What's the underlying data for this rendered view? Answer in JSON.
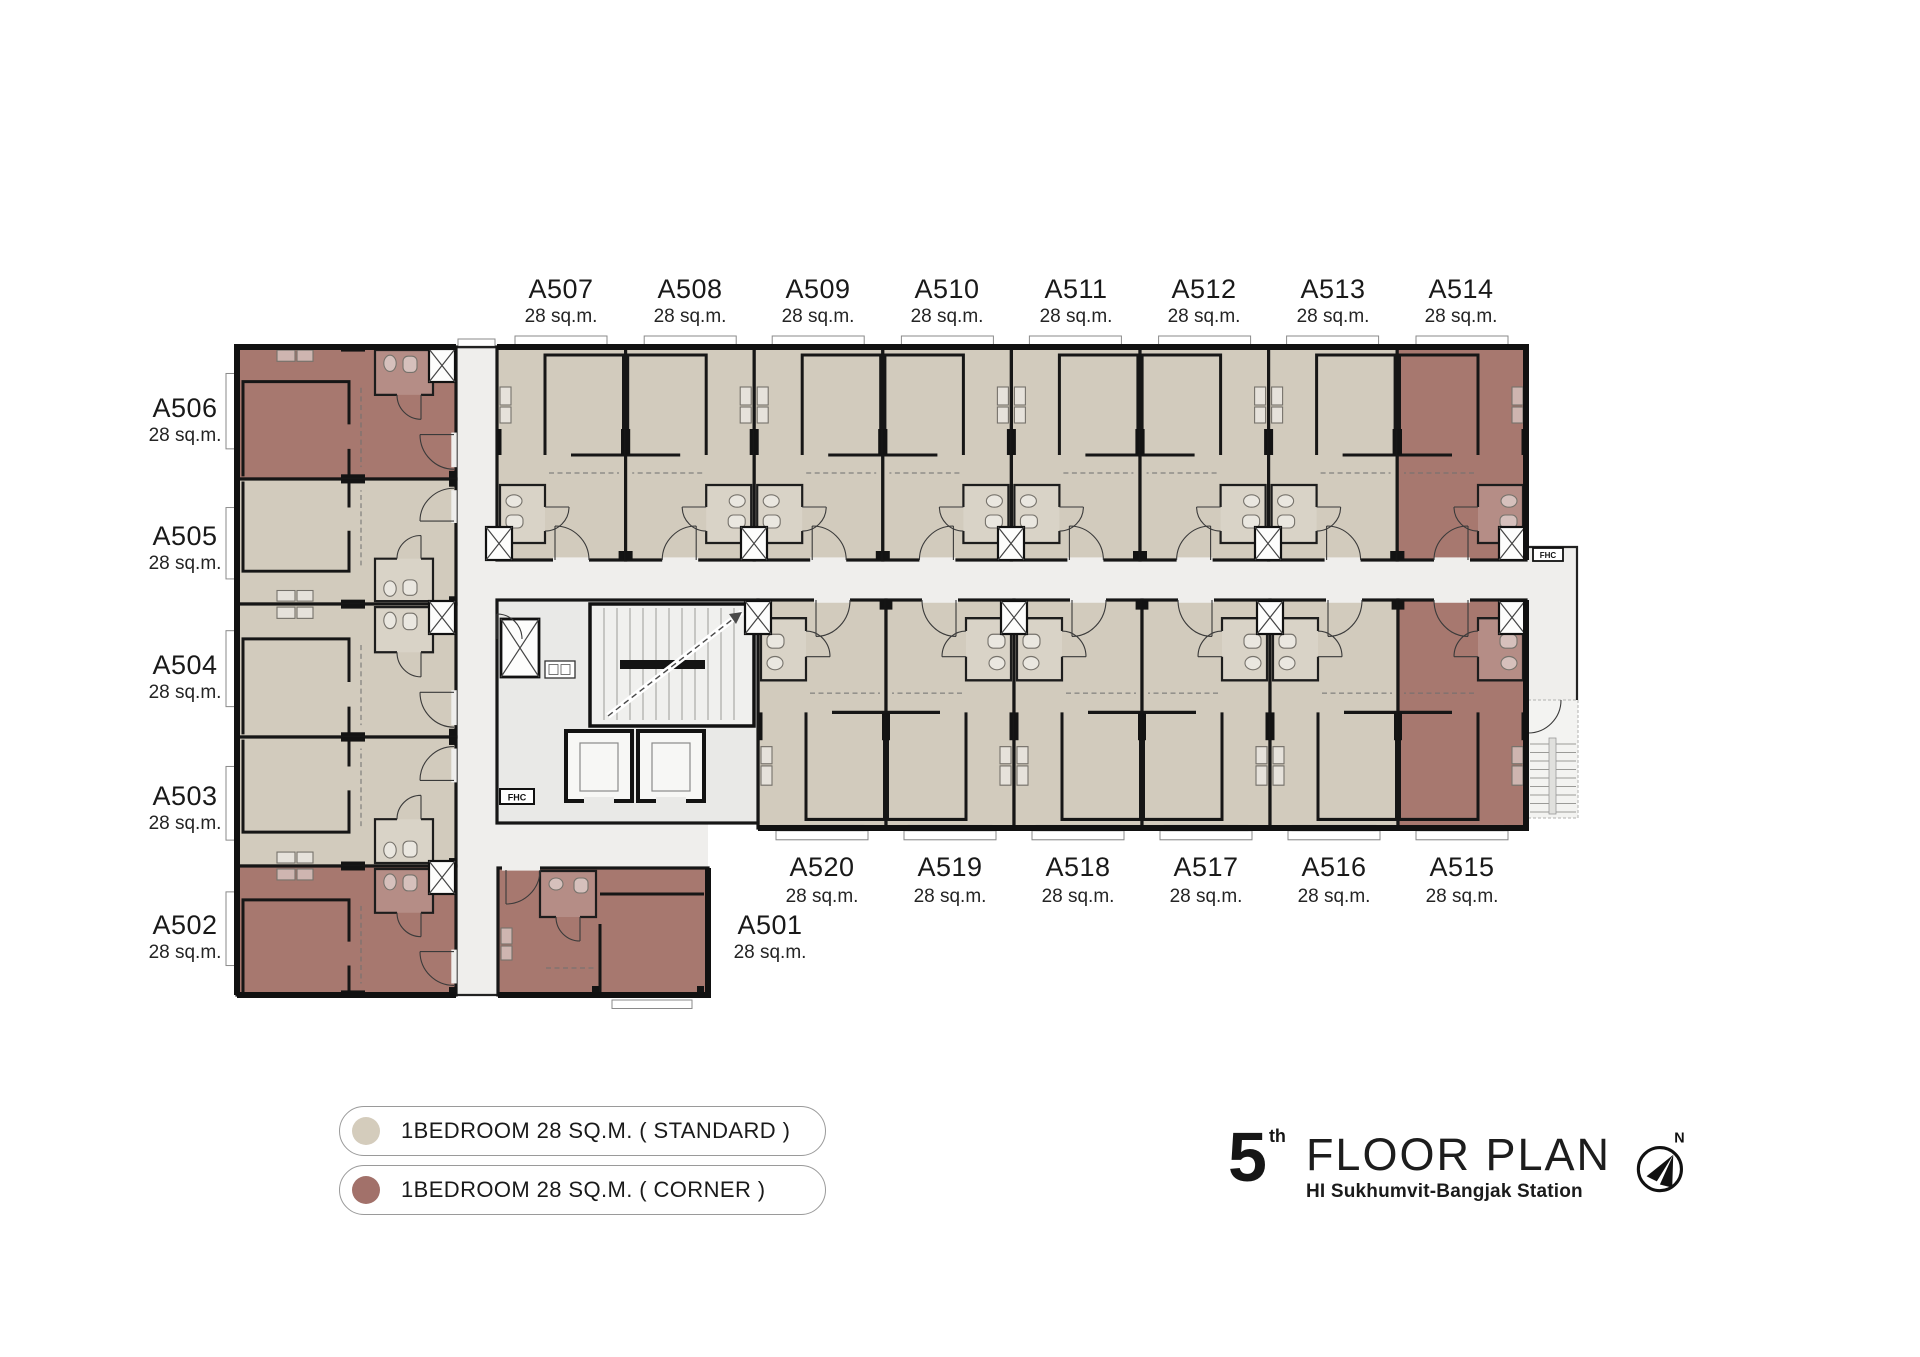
{
  "units": [
    {
      "id": "A501",
      "area": "28 sq.m.",
      "type": "corner"
    },
    {
      "id": "A502",
      "area": "28 sq.m.",
      "type": "corner"
    },
    {
      "id": "A503",
      "area": "28 sq.m.",
      "type": "standard"
    },
    {
      "id": "A504",
      "area": "28 sq.m.",
      "type": "standard"
    },
    {
      "id": "A505",
      "area": "28 sq.m.",
      "type": "standard"
    },
    {
      "id": "A506",
      "area": "28 sq.m.",
      "type": "corner"
    },
    {
      "id": "A507",
      "area": "28 sq.m.",
      "type": "standard"
    },
    {
      "id": "A508",
      "area": "28 sq.m.",
      "type": "standard"
    },
    {
      "id": "A509",
      "area": "28 sq.m.",
      "type": "standard"
    },
    {
      "id": "A510",
      "area": "28 sq.m.",
      "type": "standard"
    },
    {
      "id": "A511",
      "area": "28 sq.m.",
      "type": "standard"
    },
    {
      "id": "A512",
      "area": "28 sq.m.",
      "type": "standard"
    },
    {
      "id": "A513",
      "area": "28 sq.m.",
      "type": "standard"
    },
    {
      "id": "A514",
      "area": "28 sq.m.",
      "type": "corner"
    },
    {
      "id": "A515",
      "area": "28 sq.m.",
      "type": "corner"
    },
    {
      "id": "A516",
      "area": "28 sq.m.",
      "type": "standard"
    },
    {
      "id": "A517",
      "area": "28 sq.m.",
      "type": "standard"
    },
    {
      "id": "A518",
      "area": "28 sq.m.",
      "type": "standard"
    },
    {
      "id": "A519",
      "area": "28 sq.m.",
      "type": "standard"
    },
    {
      "id": "A520",
      "area": "28 sq.m.",
      "type": "standard"
    }
  ],
  "legend": {
    "standard_label": "1BEDROOM 28 SQ.M. ( STANDARD )",
    "corner_label": "1BEDROOM 28 SQ.M. ( CORNER )"
  },
  "title": {
    "floor_number": "5",
    "floor_ordinal": "th",
    "heading": "FLOOR PLAN",
    "subtitle": "HI Sukhumvit-Bangjak Station",
    "compass_label": "N"
  },
  "core": {
    "fire_hose_cabinet": "FHC",
    "fire_hose_cabinet_right": "FHC"
  },
  "colors": {
    "standard": "#d4ccbc",
    "corner": "#a2716a",
    "corridor": "#efeeec",
    "wall": "#161616"
  }
}
